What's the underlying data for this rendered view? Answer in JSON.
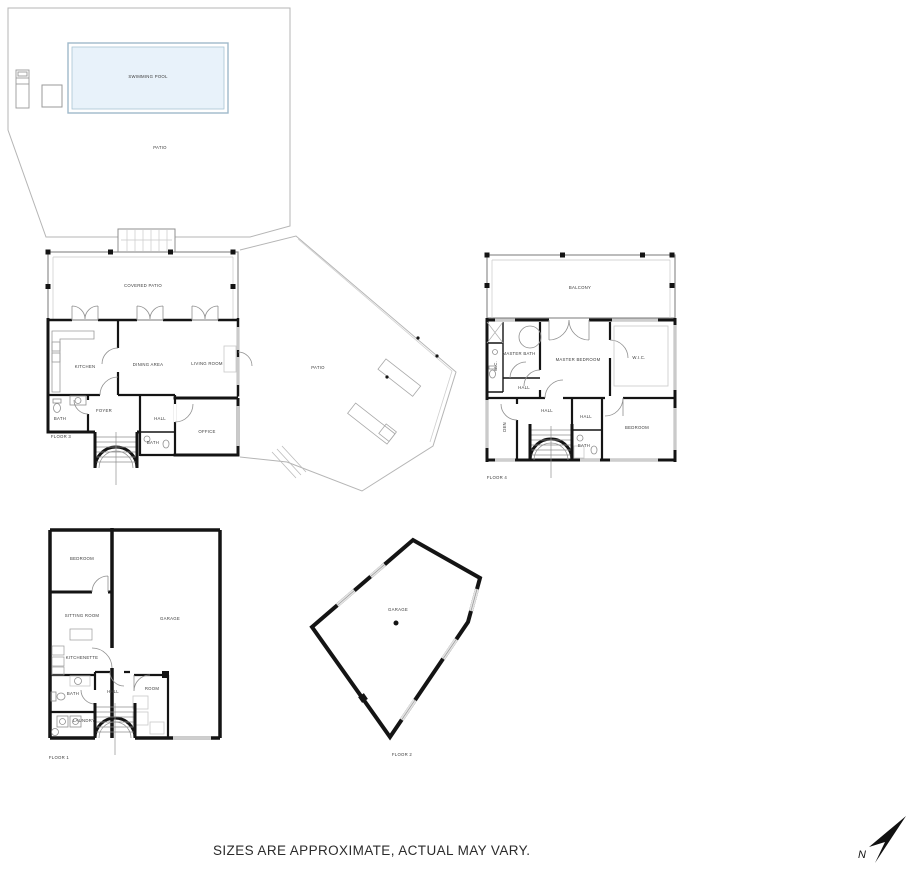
{
  "site": {
    "swimming_pool": "SWIMMING POOL",
    "patio": "PATIO"
  },
  "floor3": {
    "covered_patio": "COVERED PATIO",
    "kitchen": "KITCHEN",
    "dining_area": "DINING AREA",
    "living_room": "LIVING ROOM",
    "bath_left": "BATH",
    "foyer": "FOYER",
    "hall": "HALL",
    "bath_small": "BATH",
    "office": "OFFICE",
    "patio": "PATIO",
    "floor_label": "FLOOR 3"
  },
  "floor4": {
    "balcony": "BALCONY",
    "master_bath": "MASTER BATH",
    "wc": "W.C.",
    "master_bedroom": "MASTER BEDROOM",
    "wic": "W.I.C.",
    "hall_upper": "HALL",
    "hall_mid": "HALL",
    "hall_small": "HALL",
    "bath": "BATH",
    "bedroom": "BEDROOM",
    "den": "DEN",
    "floor_label": "FLOOR 4"
  },
  "floor1": {
    "bedroom": "BEDROOM",
    "sitting_room": "SITTING ROOM",
    "kitchenette": "KITCHENETTE",
    "garage": "GARAGE",
    "bath": "BATH",
    "hall": "HALL",
    "room": "ROOM",
    "laundry": "LAUNDRY",
    "floor_label": "FLOOR 1"
  },
  "floor2": {
    "garage": "GARAGE",
    "floor_label": "FLOOR 2"
  },
  "footer": {
    "disclaimer": "SIZES ARE APPROXIMATE, ACTUAL MAY VARY.",
    "north_letter": "N"
  },
  "colors": {
    "pool_fill": "#e8f2fa",
    "wall": "#141414",
    "thin_line": "#8f8f8f",
    "label_text": "#3b3b3b"
  }
}
